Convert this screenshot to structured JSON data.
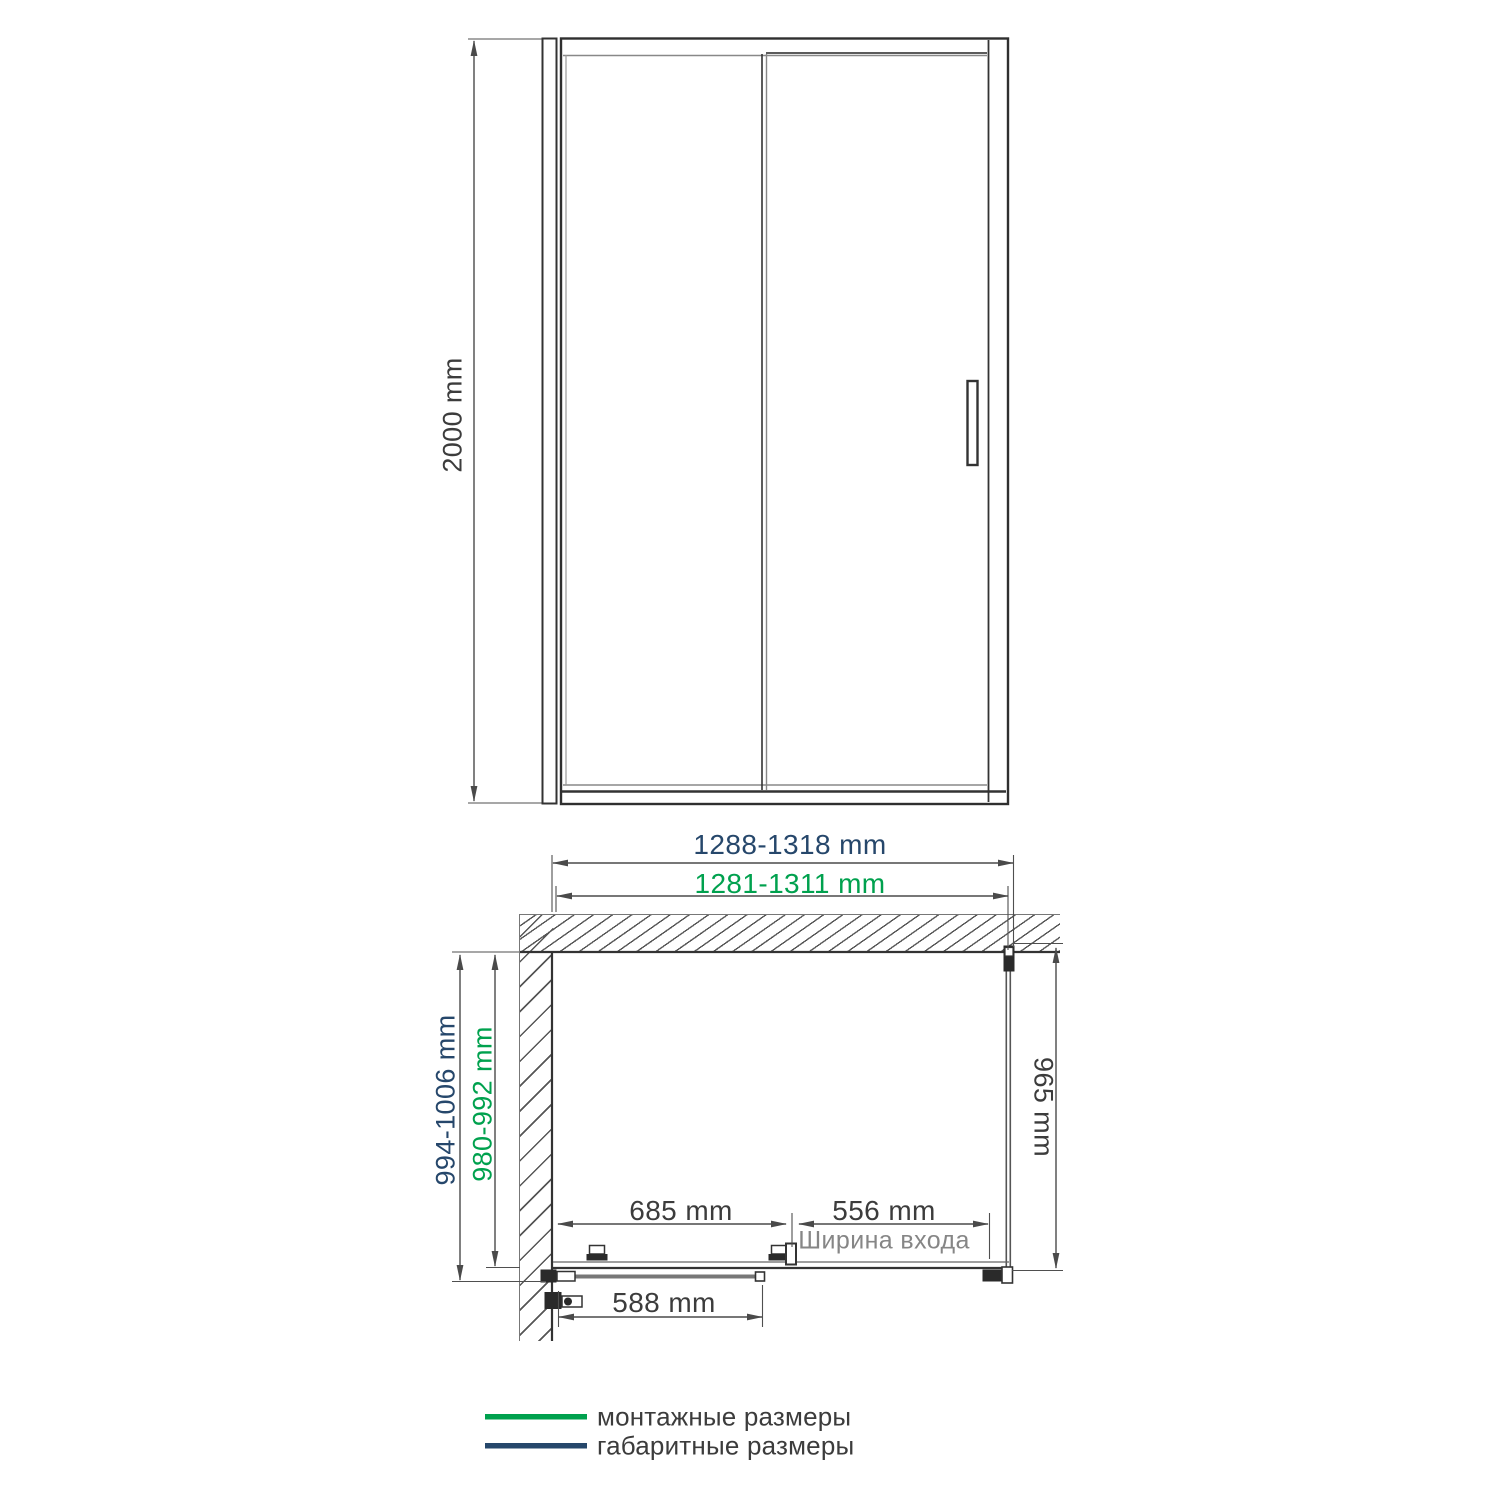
{
  "drawing": {
    "front_view": {
      "height": "2000 mm"
    },
    "plan_view": {
      "overall_width": "1288-1318 mm",
      "mounting_width": "1281-1311 mm",
      "overall_depth": "994-1006 mm",
      "mounting_depth": "980-992 mm",
      "side_panel_depth": "965 mm",
      "door_section_width": "685 mm",
      "entry_width": "556 mm",
      "entry_width_caption": "Ширина входа",
      "door_glass_width": "588 mm"
    },
    "legend": {
      "mounting_label": "монтажные размеры",
      "overall_label": "габаритные размеры",
      "mounting_color": "#00a14e",
      "overall_color": "#26476b"
    }
  }
}
